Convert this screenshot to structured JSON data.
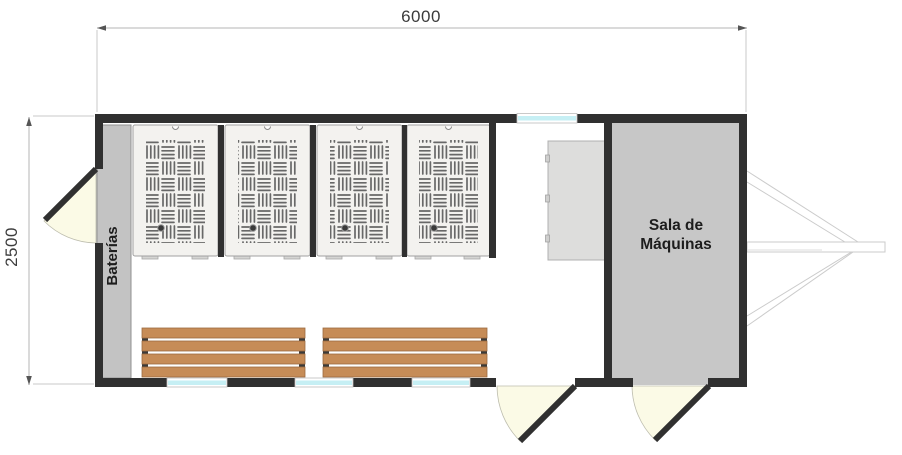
{
  "drawing": {
    "type": "floor-plan",
    "annotations": {
      "width_dimension": "6000",
      "height_dimension": "2500"
    },
    "rooms": {
      "machine_room": "Sala de Máquinas",
      "machine_room_line1": "Sala de",
      "machine_room_line2": "Máquinas",
      "battery_area": "Baterías"
    },
    "features": {
      "lockers_count": 4,
      "benches_count": 2,
      "doors_count": 3,
      "windows_count": 4
    },
    "colors": {
      "wall": "#303030",
      "locker_fill": "#f3f2ef",
      "hatch_lines": "#686868",
      "battery_cabinet": "#c3c3c3",
      "machine_room_fill": "#c7c7c7",
      "bench_wood": "#c68c57",
      "window_glass": "#c6eff4",
      "door_swing": "#fbfae6",
      "dimension_line": "#b5b5b5"
    }
  }
}
